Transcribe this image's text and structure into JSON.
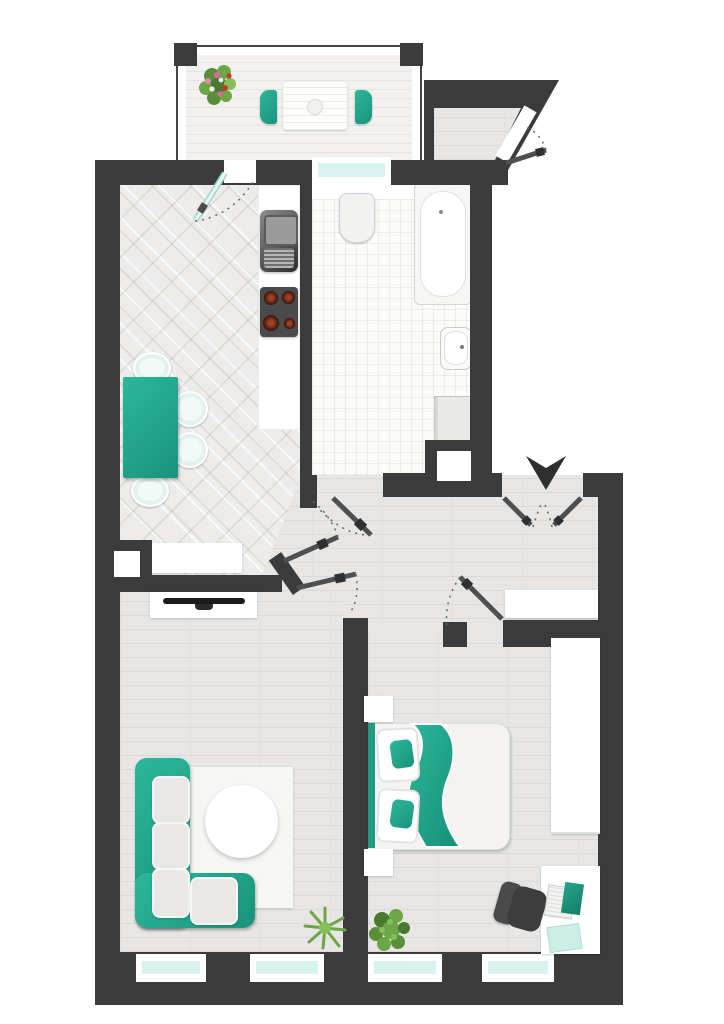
{
  "floor_plan": {
    "type": "apartment-top-view",
    "colors": {
      "wall": "#3b3b3b",
      "accent_teal": "#21a189",
      "window_glass": "#d8f3ef",
      "plank_floor": "#e7e6e4",
      "kitchen_tile": "#edecea",
      "bathroom_tile": "#fbfbfa",
      "door_leaf": "#4f4f4f",
      "glass_door_leaf": "#bfe8e2",
      "plant_green": "#6da647",
      "flower_pink": "#d96a9e",
      "flower_red": "#c23a2b"
    },
    "rooms": [
      {
        "name": "balcony",
        "floor": "wood-deck",
        "furniture": [
          "outdoor-table",
          "outdoor-chair-left",
          "outdoor-chair-right",
          "flower-pot"
        ]
      },
      {
        "name": "kitchen-dining",
        "floor": "diagonal-tile",
        "furniture": [
          "kitchen-counter",
          "kitchen-sink",
          "stove-4-burners",
          "dining-table",
          "dining-chair x4",
          "sideboard",
          "shaft"
        ]
      },
      {
        "name": "bathroom",
        "floor": "small-tile",
        "furniture": [
          "toilet",
          "bathtub",
          "washbasin",
          "washing-machine",
          "shelf",
          "shaft"
        ]
      },
      {
        "name": "entry-vestibule",
        "floor": "wood-plank",
        "furniture": [
          "entry-door-diagonal"
        ]
      },
      {
        "name": "hallway",
        "floor": "wood-plank",
        "furniture": [
          "wardrobe-sideboard",
          "entrance-double-door",
          "entrance-arrow"
        ]
      },
      {
        "name": "living-room",
        "floor": "wood-plank",
        "furniture": [
          "tv-sideboard",
          "tv",
          "corner-sofa",
          "rug",
          "coffee-table",
          "plant"
        ]
      },
      {
        "name": "bedroom",
        "floor": "wood-plank",
        "furniture": [
          "double-bed",
          "pillow x2",
          "teal-blanket",
          "nightstand x2",
          "wardrobe",
          "desk",
          "office-chair",
          "laptop",
          "notepad",
          "plant"
        ]
      }
    ],
    "windows": {
      "count": 6,
      "locations": [
        "bathroom-to-balcony",
        "living-room-south x2",
        "bedroom-south x2",
        "balcony-door-glass"
      ]
    },
    "doors": [
      {
        "name": "balcony-glass-door",
        "type": "glass-single"
      },
      {
        "name": "bathroom-door",
        "type": "single"
      },
      {
        "name": "kitchen-door",
        "type": "single"
      },
      {
        "name": "living-room-door",
        "type": "single"
      },
      {
        "name": "bedroom-door",
        "type": "single"
      },
      {
        "name": "apartment-entrance-door",
        "type": "double"
      },
      {
        "name": "stairwell-entry-door",
        "type": "single-diagonal"
      }
    ]
  }
}
